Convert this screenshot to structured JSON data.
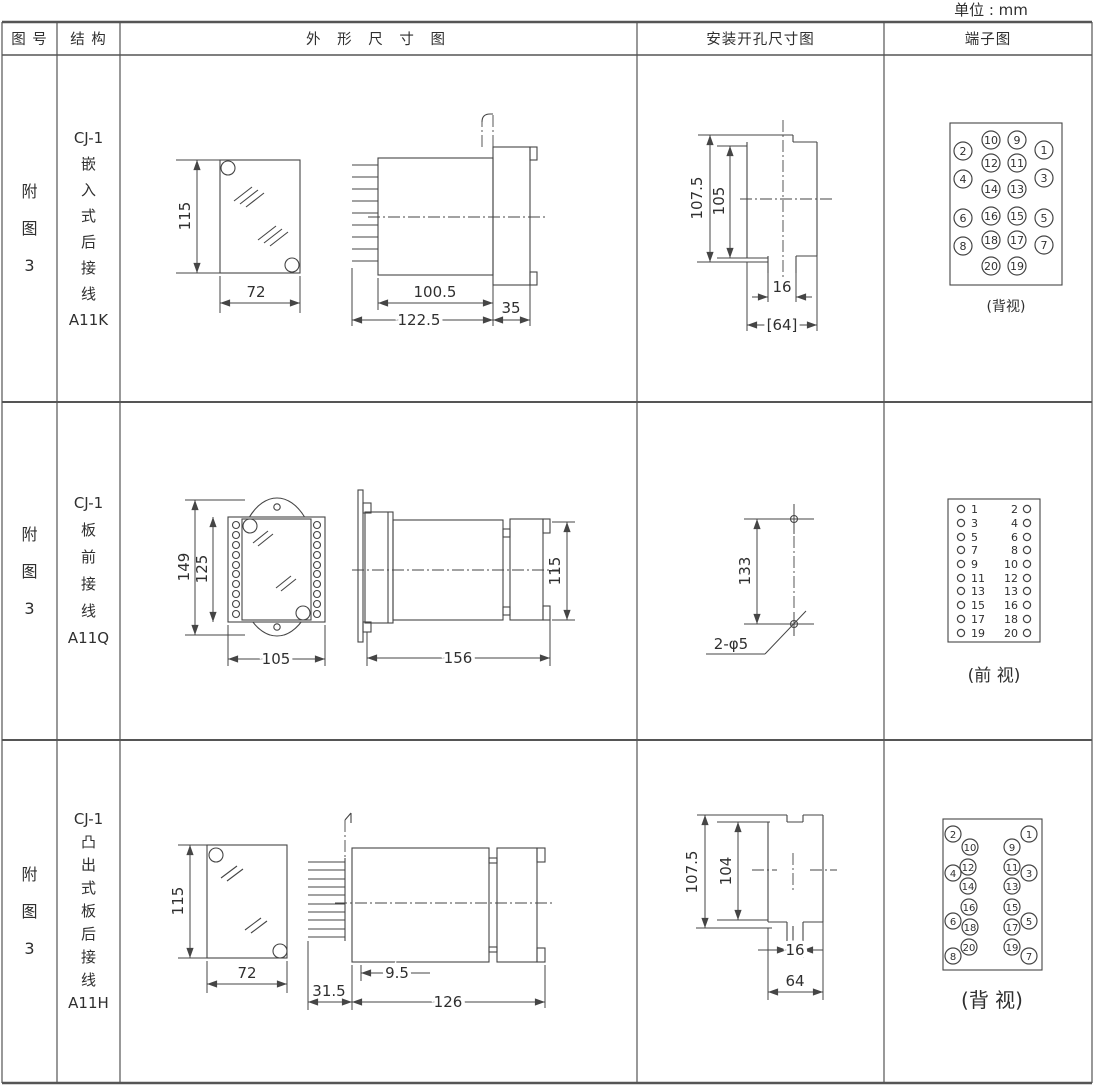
{
  "unit_label": "单位 : mm",
  "header": {
    "figure": "图 号",
    "structure": "结 构",
    "outline": "外 形 尺 寸 图",
    "mounting": "安装开孔尺寸图",
    "terminal": "端子图"
  },
  "rows": [
    {
      "figure_no": "附\n图\n3",
      "structure": "CJ-1\n嵌\n入\n式\n后\n接\n线\nA11K",
      "outline": {
        "h": "115",
        "w": "72",
        "body": "100.5",
        "total": "122.5",
        "flange": "35"
      },
      "mounting": {
        "outer": "107.5",
        "inner": "105",
        "slot": "16",
        "width": "[64]"
      },
      "terminal_caption": "(背视)"
    },
    {
      "figure_no": "附\n图\n3",
      "structure": "CJ-1\n板\n前\n接\n线\nA11Q",
      "outline": {
        "outer_h": "149",
        "inner_h": "125",
        "w": "105",
        "len": "156",
        "h": "115"
      },
      "mounting": {
        "pitch": "133",
        "holes": "2-φ5"
      },
      "terminal_caption": "(前 视)"
    },
    {
      "figure_no": "附\n图\n3",
      "structure": "CJ-1\n凸\n出\n式\n板\n后\n接\n线\nA11H",
      "outline": {
        "h": "115",
        "w": "72",
        "pins": "31.5",
        "plate": "9.5",
        "len": "126"
      },
      "mounting": {
        "outer": "107.5",
        "inner": "104",
        "slot": "16",
        "width": "64"
      },
      "terminal_caption": "(背 视)"
    }
  ],
  "terminal_diagrams": [
    {
      "gid": "term1",
      "fs": 11,
      "r": 9,
      "items": [
        {
          "n": "1",
          "cx": 1044,
          "cy": 150
        },
        {
          "n": "2",
          "cx": 963,
          "cy": 151
        },
        {
          "n": "3",
          "cx": 1044,
          "cy": 178
        },
        {
          "n": "4",
          "cx": 963,
          "cy": 179
        },
        {
          "n": "5",
          "cx": 1044,
          "cy": 218
        },
        {
          "n": "6",
          "cx": 963,
          "cy": 218
        },
        {
          "n": "7",
          "cx": 1044,
          "cy": 245
        },
        {
          "n": "8",
          "cx": 963,
          "cy": 246
        },
        {
          "n": "9",
          "cx": 1017,
          "cy": 140
        },
        {
          "n": "10",
          "cx": 991,
          "cy": 140
        },
        {
          "n": "11",
          "cx": 1017,
          "cy": 163
        },
        {
          "n": "12",
          "cx": 991,
          "cy": 163
        },
        {
          "n": "13",
          "cx": 1017,
          "cy": 189
        },
        {
          "n": "14",
          "cx": 991,
          "cy": 189
        },
        {
          "n": "15",
          "cx": 1017,
          "cy": 216
        },
        {
          "n": "16",
          "cx": 991,
          "cy": 216
        },
        {
          "n": "17",
          "cx": 1017,
          "cy": 240
        },
        {
          "n": "18",
          "cx": 991,
          "cy": 240
        },
        {
          "n": "19",
          "cx": 1017,
          "cy": 266
        },
        {
          "n": "20",
          "cx": 991,
          "cy": 266
        }
      ]
    },
    {
      "gid": "term2",
      "fs": 11,
      "r": 3.6,
      "items": [
        {
          "n": "1",
          "cx": 961,
          "cy": 509,
          "tx": 971,
          "ta": "start"
        },
        {
          "n": "2",
          "cx": 1027,
          "cy": 509,
          "tx": 1018,
          "ta": "end"
        },
        {
          "n": "3",
          "cx": 961,
          "cy": 523,
          "tx": 971,
          "ta": "start"
        },
        {
          "n": "4",
          "cx": 1027,
          "cy": 523,
          "tx": 1018,
          "ta": "end"
        },
        {
          "n": "5",
          "cx": 961,
          "cy": 537,
          "tx": 971,
          "ta": "start"
        },
        {
          "n": "6",
          "cx": 1027,
          "cy": 537,
          "tx": 1018,
          "ta": "end"
        },
        {
          "n": "7",
          "cx": 961,
          "cy": 550,
          "tx": 971,
          "ta": "start"
        },
        {
          "n": "8",
          "cx": 1027,
          "cy": 550,
          "tx": 1018,
          "ta": "end"
        },
        {
          "n": "9",
          "cx": 961,
          "cy": 564,
          "tx": 971,
          "ta": "start"
        },
        {
          "n": "10",
          "cx": 1027,
          "cy": 564,
          "tx": 1018,
          "ta": "end"
        },
        {
          "n": "11",
          "cx": 961,
          "cy": 578,
          "tx": 971,
          "ta": "start"
        },
        {
          "n": "12",
          "cx": 1027,
          "cy": 578,
          "tx": 1018,
          "ta": "end"
        },
        {
          "n": "13",
          "cx": 961,
          "cy": 591,
          "tx": 971,
          "ta": "start"
        },
        {
          "n": "13",
          "cx": 1027,
          "cy": 591,
          "tx": 1018,
          "ta": "end"
        },
        {
          "n": "15",
          "cx": 961,
          "cy": 605,
          "tx": 971,
          "ta": "start"
        },
        {
          "n": "16",
          "cx": 1027,
          "cy": 605,
          "tx": 1018,
          "ta": "end"
        },
        {
          "n": "17",
          "cx": 961,
          "cy": 619,
          "tx": 971,
          "ta": "start"
        },
        {
          "n": "18",
          "cx": 1027,
          "cy": 619,
          "tx": 1018,
          "ta": "end"
        },
        {
          "n": "19",
          "cx": 961,
          "cy": 633,
          "tx": 971,
          "ta": "start"
        },
        {
          "n": "20",
          "cx": 1027,
          "cy": 633,
          "tx": 1018,
          "ta": "end"
        }
      ]
    },
    {
      "gid": "term3",
      "fs": 10,
      "r": 8,
      "items": [
        {
          "n": "1",
          "cx": 1029,
          "cy": 834
        },
        {
          "n": "2",
          "cx": 953,
          "cy": 834
        },
        {
          "n": "9",
          "cx": 1012,
          "cy": 847
        },
        {
          "n": "10",
          "cx": 970,
          "cy": 847
        },
        {
          "n": "11",
          "cx": 1012,
          "cy": 867
        },
        {
          "n": "12",
          "cx": 968,
          "cy": 867
        },
        {
          "n": "3",
          "cx": 1029,
          "cy": 873
        },
        {
          "n": "4",
          "cx": 953,
          "cy": 873
        },
        {
          "n": "13",
          "cx": 1012,
          "cy": 886
        },
        {
          "n": "14",
          "cx": 968,
          "cy": 886
        },
        {
          "n": "15",
          "cx": 1012,
          "cy": 907
        },
        {
          "n": "16",
          "cx": 969,
          "cy": 907
        },
        {
          "n": "5",
          "cx": 1029,
          "cy": 921
        },
        {
          "n": "6",
          "cx": 953,
          "cy": 921
        },
        {
          "n": "17",
          "cx": 1012,
          "cy": 927
        },
        {
          "n": "18",
          "cx": 970,
          "cy": 927
        },
        {
          "n": "19",
          "cx": 1012,
          "cy": 947
        },
        {
          "n": "20",
          "cx": 969,
          "cy": 947
        },
        {
          "n": "7",
          "cx": 1029,
          "cy": 956
        },
        {
          "n": "8",
          "cx": 953,
          "cy": 956
        }
      ]
    }
  ]
}
